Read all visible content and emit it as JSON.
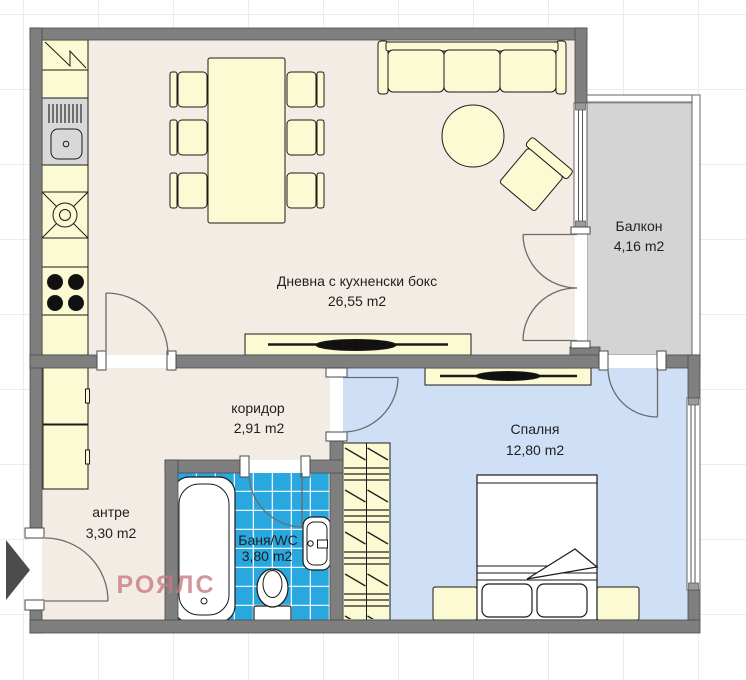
{
  "plan": {
    "rooms": {
      "living": {
        "name": "Дневна с кухненски бокс",
        "area": "26,55 m2"
      },
      "balcony": {
        "name": "Балкон",
        "area": "4,16 m2"
      },
      "corridor": {
        "name": "коридор",
        "area": "2,91 m2"
      },
      "bedroom": {
        "name": "Спалня",
        "area": "12,80 m2"
      },
      "entry": {
        "name": "антре",
        "area": "3,30 m2"
      },
      "bathroom": {
        "name": "Баня/WC",
        "area": "3,80 m2"
      }
    },
    "watermark": "РОЯЛС",
    "colors": {
      "wall": "#7f7f7f",
      "floor_main": "#f2ece4",
      "floor_bedroom": "#cfe0f6",
      "bath_tile": "#29a8e0",
      "balcony_floor": "#d4d4d4",
      "furniture": "#fbfad2",
      "watermark": "#c87880"
    }
  }
}
